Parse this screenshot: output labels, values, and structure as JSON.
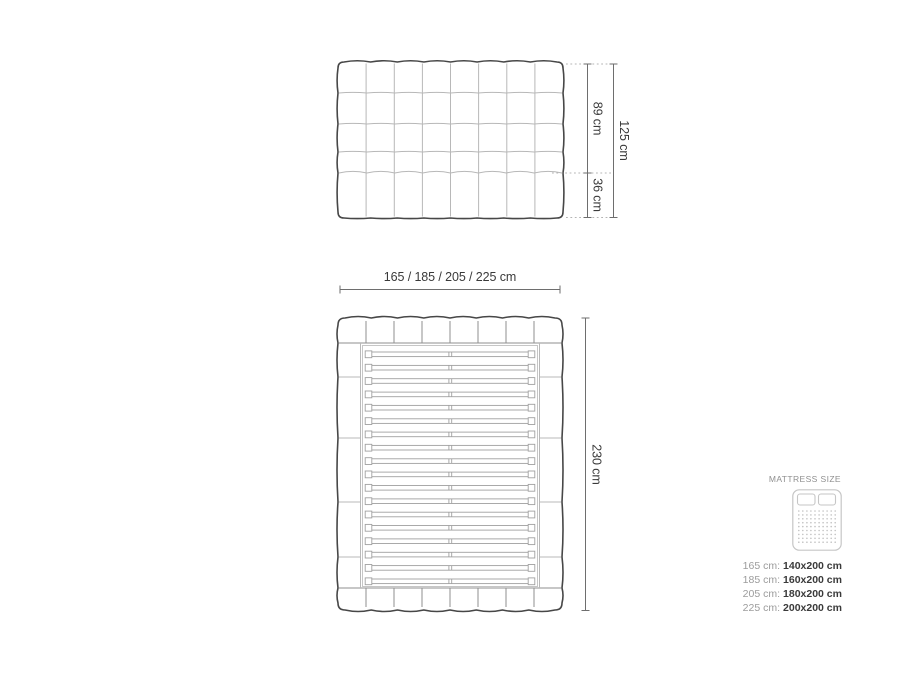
{
  "colors": {
    "outline": "#474747",
    "grid": "#b8b8b8",
    "mid_grid": "#8f8f8f",
    "light_grid": "#c6c6c6",
    "slat": "#a0a0a0",
    "dim_line": "#6e6e6e",
    "leader": "#b4b4b4",
    "dim_text": "#3a3a3a",
    "icon_stroke": "#c6c6c6",
    "icon_dot": "#c2c2c2"
  },
  "front_view": {
    "columns": 8,
    "upper_rows": 4,
    "label_upper": "89 cm",
    "label_lower": "36 cm",
    "label_total": "125 cm"
  },
  "top_view": {
    "label_width": "165 / 185 / 205 / 225 cm",
    "label_length": "230 cm",
    "headboard_segments": 8,
    "footboard_segments": 8,
    "rail_segments": 5,
    "slat_count": 18
  },
  "legend": {
    "title": "MATTRESS SIZE",
    "icon": "mattress-icon",
    "icon_dot_rows": 9,
    "icon_dot_cols": 10,
    "rows": [
      {
        "frame": "165 cm:",
        "mattress": "140x200 cm"
      },
      {
        "frame": "185 cm:",
        "mattress": "160x200 cm"
      },
      {
        "frame": "205 cm:",
        "mattress": "180x200 cm"
      },
      {
        "frame": "225 cm:",
        "mattress": "200x200 cm"
      }
    ]
  }
}
